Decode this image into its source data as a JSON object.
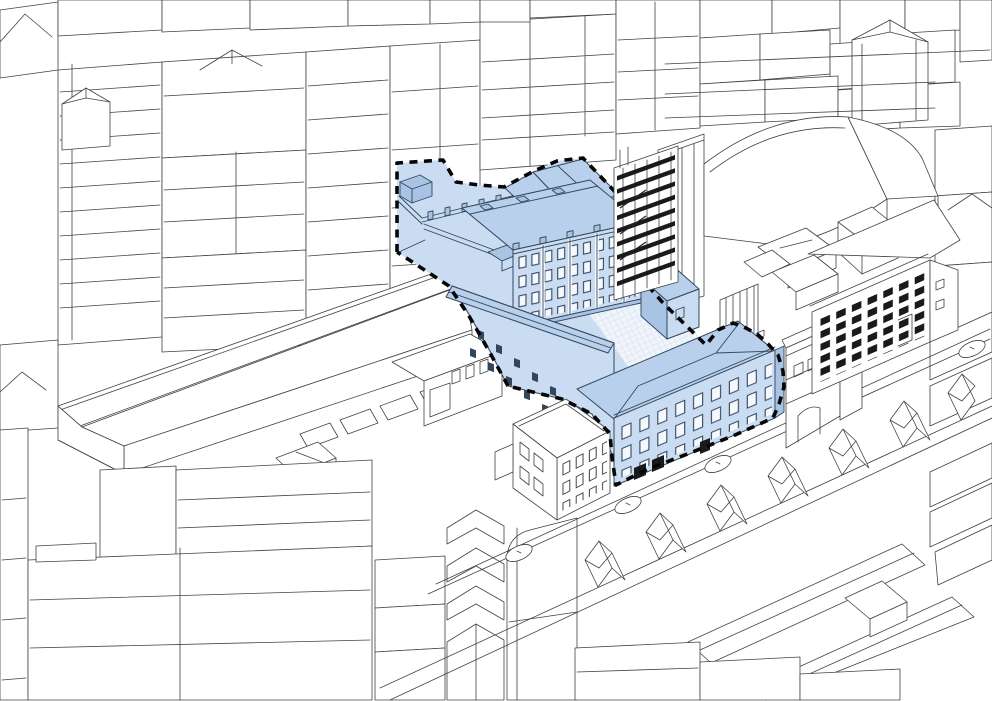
{
  "page": {
    "title": "Axonometric urban massing diagram with highlighted development site"
  },
  "colors": {
    "background": "#ffffff",
    "line": "#424242",
    "site_line": "#33475c",
    "site_fill": "#c9dcf2",
    "site_roof": "#b9d0ec",
    "site_shadow": "#a9c3e4",
    "window_white": "#f5f9ff",
    "dark": "#1a1a1a",
    "boundary": "#060606",
    "court_bg": "#f0f4fb",
    "court_grid": "#bfd0e8"
  },
  "site": {
    "boundary_style": "dashed",
    "highlight": "light-blue",
    "buildings": [
      {
        "name": "terrace-block",
        "note": "roof terrace with parapet and pilasters"
      },
      {
        "name": "north-east-head-block",
        "note": "hipped blue roof at top of site"
      },
      {
        "name": "four-storey-block",
        "note": "4 window rows, pilastered facade"
      },
      {
        "name": "south-west-wing",
        "note": "long wing with scattered small windows"
      },
      {
        "name": "street-terrace-block",
        "note": "3 window rows facing street, hipped roof"
      }
    ],
    "courtyard": {
      "texture": "fine grid"
    }
  },
  "context": {
    "landmarks": [
      {
        "name": "construction-frame-tower",
        "note": "open concrete frame, dark floor slabs"
      },
      {
        "name": "barrel-roof-hall",
        "note": "large curved roof building north-east of site"
      },
      {
        "name": "dark-window-building",
        "note": "grid of dark windows, 7 columns"
      },
      {
        "name": "archway-building",
        "note": "facade with arched opening"
      },
      {
        "name": "warehouse-shed",
        "note": "long wedge roof with rooflights"
      },
      {
        "name": "corner-building",
        "note": "white 3-storey block at street corner"
      },
      {
        "name": "street",
        "manholes": 5
      },
      {
        "name": "terraced-houses",
        "note": "gabled row across the street"
      }
    ]
  }
}
